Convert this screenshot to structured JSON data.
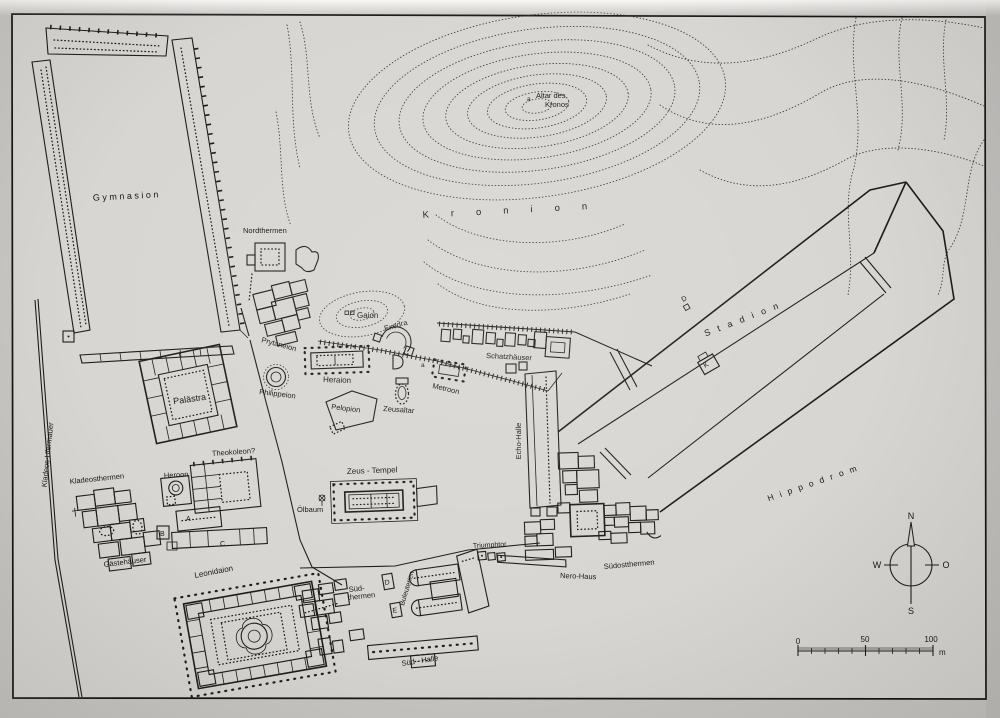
{
  "map": {
    "labels": {
      "gymnasion": "Gymnasion",
      "nordthermen": "Nordthermen",
      "altar_line1": "Altar des",
      "altar_line2": "Kronos",
      "kronion": "Kronion",
      "gaion": "Gaion",
      "exedra": "Exedra",
      "schatzhaeuser": "Schatzhäuser",
      "prytaneion": "Prytaneion",
      "heraion": "Heraion",
      "philippeion": "Philippeion",
      "pelopion": "Pelopion",
      "zeusaltar": "Zeusaltar",
      "metroon": "Metroon",
      "stadion": "Stadion",
      "echo_halle": "Echo-Halle",
      "kladeos_ufermauer": "Kladeos-Ufermauer",
      "palaestra": "Palästra",
      "theokoleon": "Theokoleon?",
      "heroon": "Heroon",
      "kladeosthermen": "Kladeosthermen",
      "gaestehaeuser": "Gästehäuser",
      "zeus_tempel": "Zeus - Tempel",
      "oelbaum": "Ölbaum",
      "leonidaion": "Leonidaion",
      "suedthermen_line1": "Süd-",
      "suedthermen_line2": "thermen",
      "buleuterien": "Buleuterien",
      "triumphtor": "Triumphtor",
      "nero_haus": "Nero-Haus",
      "suedostthermen": "Südostthermen",
      "sued_halle": "Süd - Halle",
      "hippodrom": "Hippodrom"
    },
    "markers": {
      "a_kronos": "a",
      "a_metroon": "a",
      "hall_a": "A",
      "hall_b": "B",
      "hall_c": "C",
      "stadion_d": "D",
      "stadion_k": "K",
      "box_d": "D",
      "box_e": "E"
    },
    "compass": {
      "north": "N",
      "west": "W",
      "east": "O",
      "south": "S"
    },
    "scale_bar": {
      "start": "0",
      "middle": "50",
      "end": "100",
      "unit": "m"
    },
    "colors": {
      "ink": "#1e1d1a",
      "paper": "#d8d6d2"
    }
  }
}
